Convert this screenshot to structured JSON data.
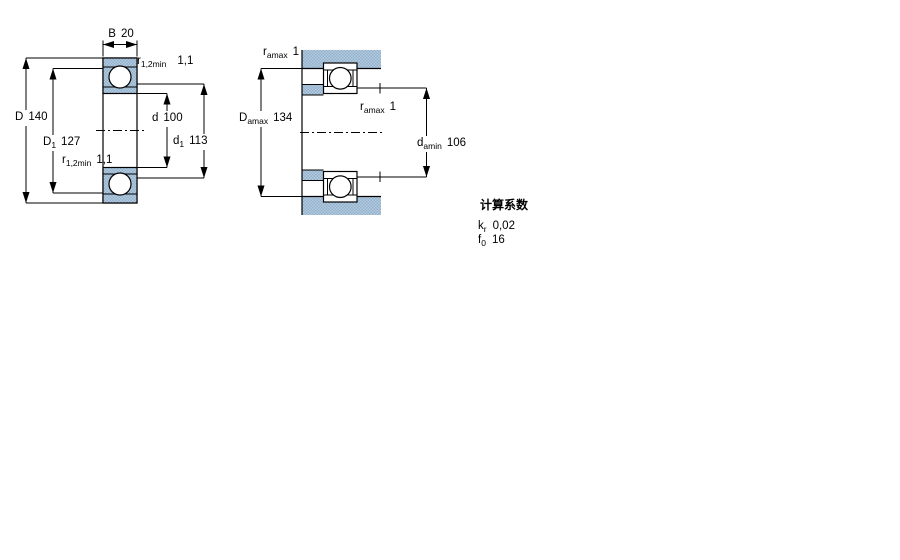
{
  "left_diagram": {
    "dim_B": {
      "sym": "B",
      "value": "20"
    },
    "dim_r_top": {
      "sym": "r",
      "sub": "1,2min",
      "value": "1,1"
    },
    "dim_D": {
      "sym": "D",
      "value": "140"
    },
    "dim_D1": {
      "sym": "D",
      "sub": "1",
      "value": "127"
    },
    "dim_d": {
      "sym": "d",
      "value": "100"
    },
    "dim_d1": {
      "sym": "d",
      "sub": "1",
      "value": "113"
    },
    "dim_r_bottom": {
      "sym": "r",
      "sub": "1,2min",
      "value": "1,1"
    }
  },
  "right_diagram": {
    "dim_ra_top": {
      "sym": "r",
      "sub": "amax",
      "value": "1"
    },
    "dim_Da": {
      "sym": "D",
      "sub": "amax",
      "value": "134"
    },
    "dim_ra_mid": {
      "sym": "r",
      "sub": "amax",
      "value": "1"
    },
    "dim_da": {
      "sym": "d",
      "sub": "amin",
      "value": "106"
    }
  },
  "calculation_factors": {
    "title": "计算系数",
    "rows": [
      {
        "sym": "k",
        "sub": "r",
        "value": "0,02"
      },
      {
        "sym": "f",
        "sub": "0",
        "value": "16"
      }
    ]
  },
  "colors": {
    "line": "#000000",
    "stipple_light": "#b5cde2",
    "stipple_dark": "#92afc9"
  }
}
